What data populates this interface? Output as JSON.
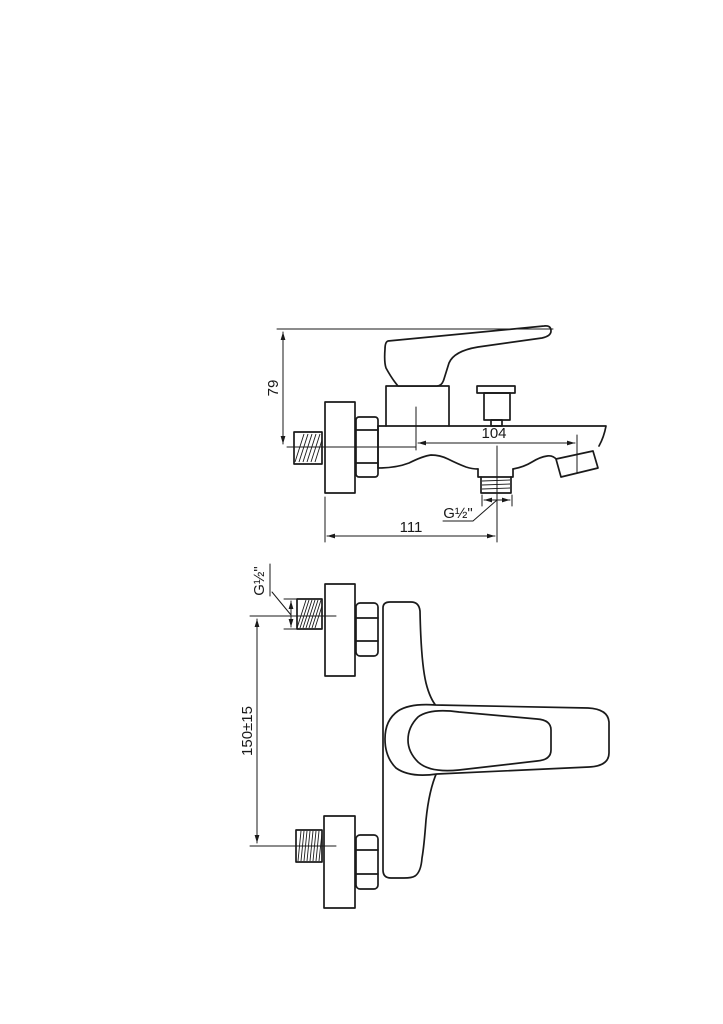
{
  "drawing": {
    "background": "#ffffff",
    "line_color": "#1a1a1a",
    "side_view": {
      "dim_height_label": "79",
      "dim_spout_reach_label": "104",
      "dim_wall_depth_label": "111",
      "outlet_thread_label": "G½\""
    },
    "front_view": {
      "inlet_thread_label": "G½\"",
      "dim_inlet_spacing_label": "150±15"
    }
  }
}
